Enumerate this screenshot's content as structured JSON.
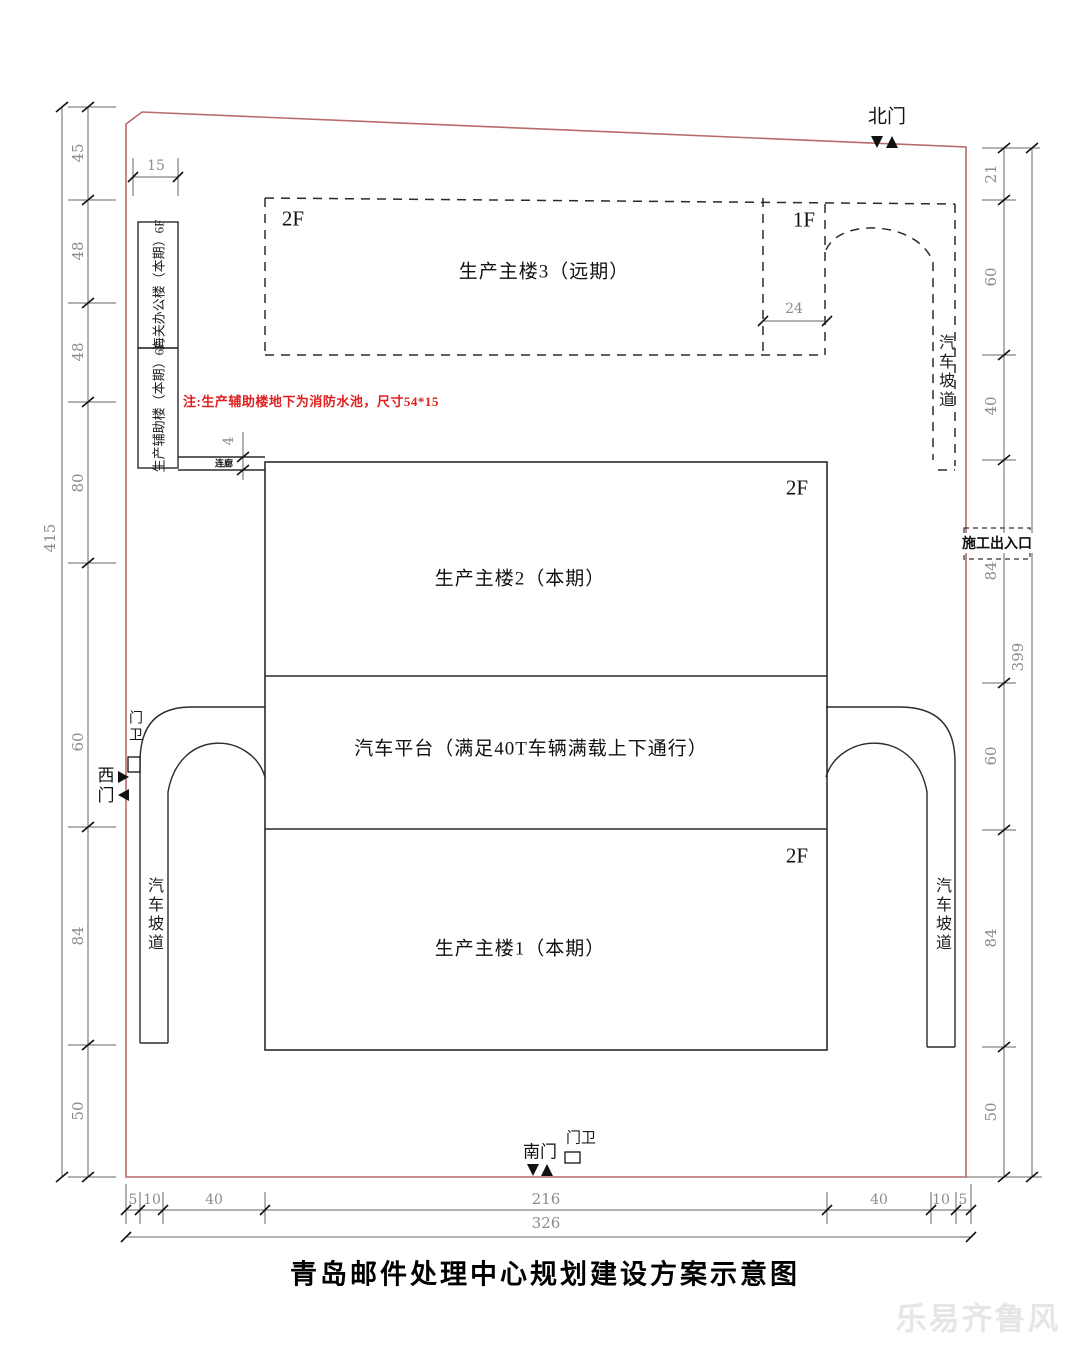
{
  "title": "青岛邮件处理中心规划建设方案示意图",
  "watermark": "乐易齐鲁风",
  "note": "注:生产辅助楼地下为消防水池，尺寸54*15",
  "buildings": {
    "main3": {
      "name": "生产主楼3（远期）",
      "floor_main": "2F",
      "floor_right": "1F"
    },
    "main2": {
      "name": "生产主楼2（本期）",
      "floor": "2F"
    },
    "platform": {
      "name": "汽车平台（满足40T车辆满载上下通行）"
    },
    "main1": {
      "name": "生产主楼1（本期）",
      "floor": "2F"
    },
    "customs": {
      "name": "海关办公楼（本期）6F"
    },
    "aux": {
      "name": "生产辅助楼（本期）6F"
    },
    "corridor": {
      "name": "连廊"
    }
  },
  "ramps": {
    "northeast": "汽车坡道",
    "southwest": "汽车坡道",
    "southeast": "汽车坡道"
  },
  "gates": {
    "north": "北门",
    "west": "西门",
    "south": "南门"
  },
  "guards": {
    "west": "门卫",
    "south": "门卫"
  },
  "construction_entrance": "施工出入口",
  "dims": {
    "left": [
      "45",
      "48",
      "48",
      "80",
      "60",
      "84",
      "50"
    ],
    "left_total": "415",
    "right": [
      "21",
      "60",
      "40",
      "84",
      "60",
      "84",
      "50"
    ],
    "right_total": "399",
    "bottom": [
      "5",
      "10",
      "40",
      "216",
      "40",
      "10",
      "5"
    ],
    "bottom_total": "326",
    "top_left": "15",
    "main3_bay": "24",
    "corridor_width": "4"
  },
  "colors": {
    "boundary": "#b96b6b",
    "note_red": "#e02020",
    "dim_gray": "#8c8c8c",
    "line": "#2b2b2b"
  }
}
